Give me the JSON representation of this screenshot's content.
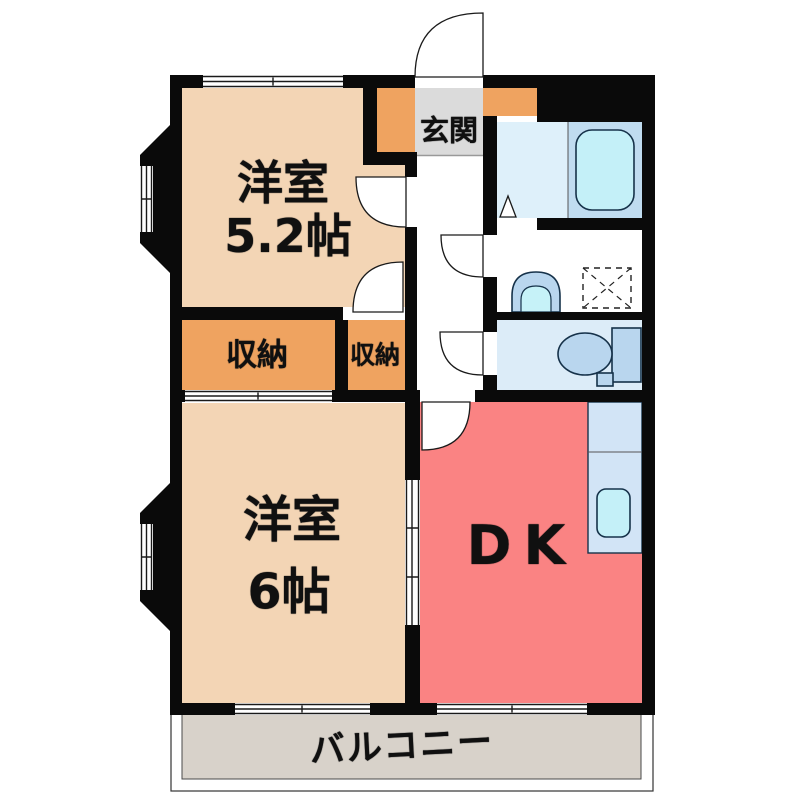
{
  "plan": {
    "type": "apartment-floor-plan",
    "labels": {
      "bedroom52_line1": "洋室",
      "bedroom52_line2": "5.2帖",
      "bedroom6_line1": "洋室",
      "bedroom6_line2": "6帖",
      "dk": "DK",
      "entry": "玄関",
      "storage_left": "収納",
      "storage_right": "収納",
      "balcony": "バルコニー"
    },
    "colors": {
      "wall": "#0a0a0a",
      "room_peach": "#f3d5b5",
      "storage_orange": "#efa360",
      "entry_gray": "#dbdbdb",
      "dk_pink": "#fa8383",
      "bath_floor": "#def0fa",
      "tub_deck": "#c0dcf0",
      "tub_fill": "#c4f0f8",
      "toilet_floor": "#dcecf8",
      "fixture_blue": "#b9d6ee",
      "fixture_inner": "#c6f2f8",
      "kitchen_counter": "#d2e4f6",
      "balcony_floor": "#d8d2ca",
      "hall_white": "#ffffff"
    }
  }
}
